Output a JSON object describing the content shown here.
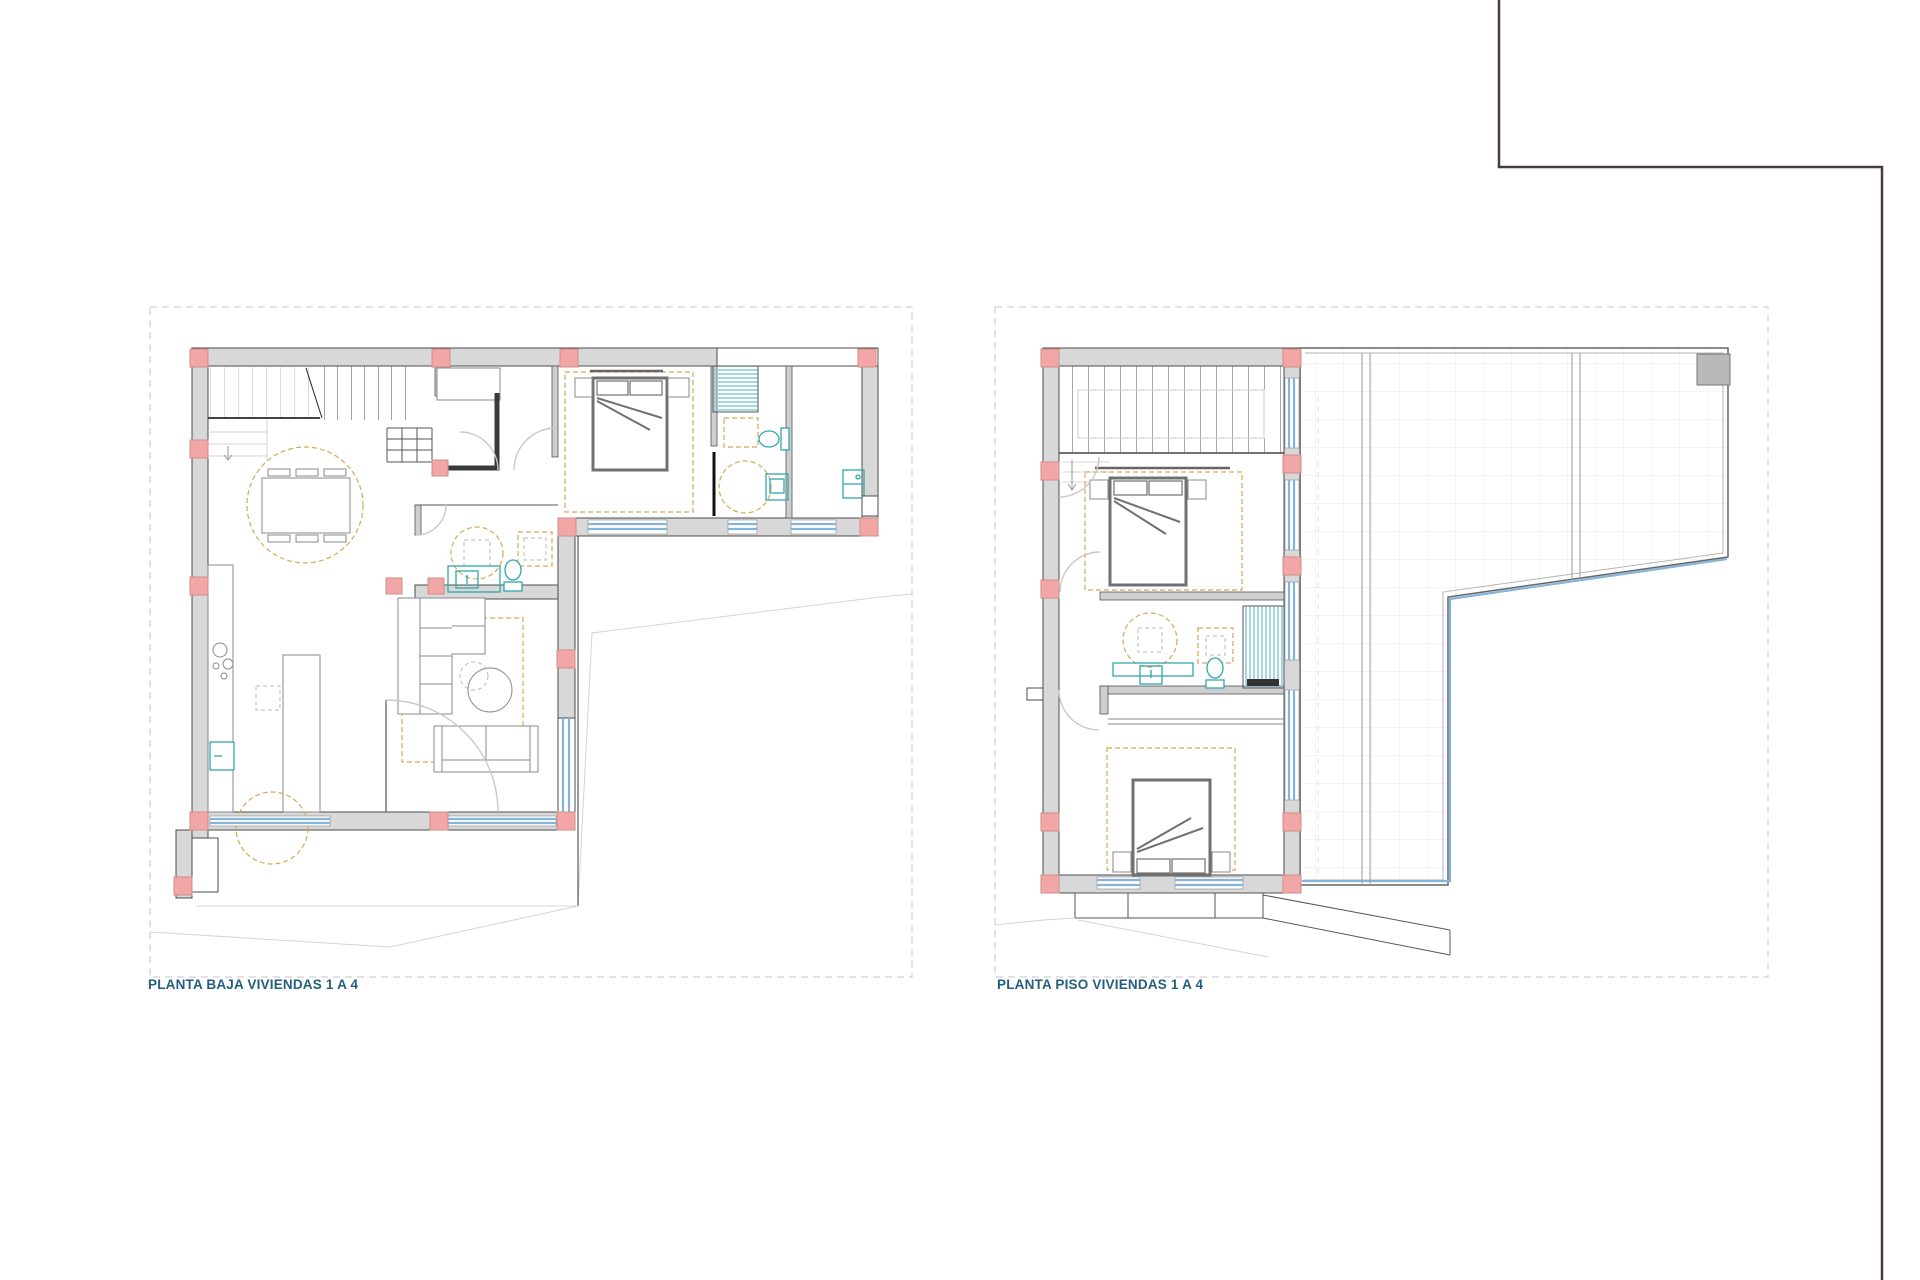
{
  "sheet": {
    "background": "#ffffff"
  },
  "plans": {
    "ground": {
      "label": "PLANTA BAJA VIVIENDAS 1 A 4"
    },
    "upper": {
      "label": "PLANTA PISO VIVIENDAS 1 A 4"
    }
  },
  "colors": {
    "label_text": "#235e7e",
    "wall_fill": "#d8d8d8",
    "wall_stroke": "#4d4d4d",
    "column_fill": "#f2a6a6",
    "column_stroke": "#cf8d8d",
    "window_glazing": "#85b4d8",
    "plumbing_fixture": "#2fa8ad",
    "shower_stripe": "#8ecfdb",
    "furniture_outline": "#8a8a8a",
    "bed_outline": "#707070",
    "rug_dashed": "#d8a855",
    "terrace_grid": "#e9e9e9",
    "boundary_dash": "#c6c6c6",
    "terrain_faint": "#d4d4d4",
    "frame_color": "#4a3c3c"
  }
}
